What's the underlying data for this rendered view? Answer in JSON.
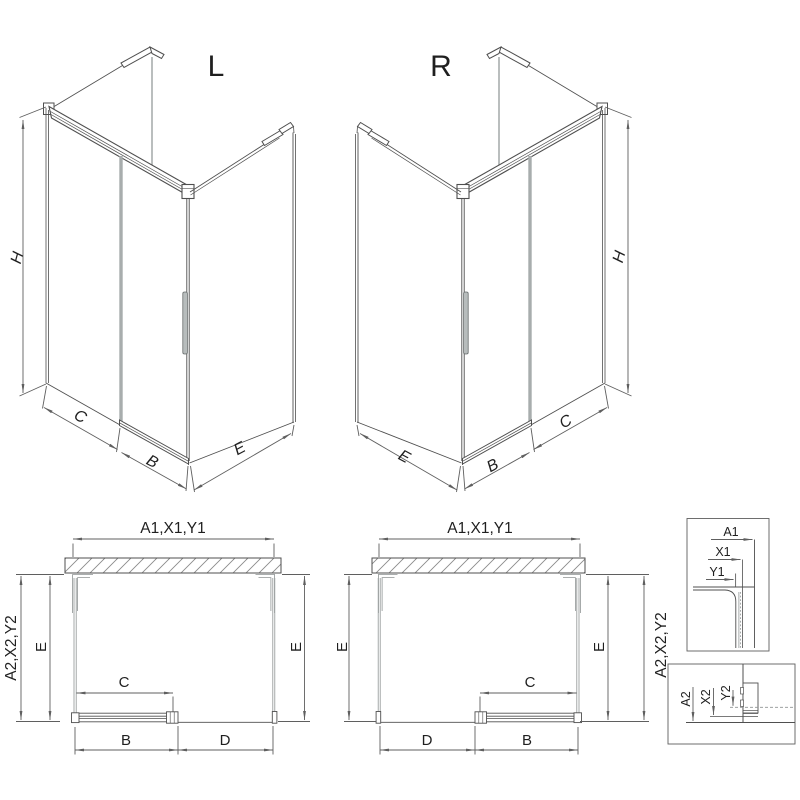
{
  "colors": {
    "line": "#4f4f4f",
    "dim": "#5f5f5f",
    "glass": "#8f9494",
    "light": "#a8adad",
    "text": "#1f1f1f",
    "hatch": "#8a8a8a"
  },
  "iso_left": {
    "title": "L",
    "dim_height": "H",
    "dim_panel": "C",
    "dim_door": "B",
    "dim_side": "E"
  },
  "iso_right": {
    "title": "R",
    "dim_height": "H",
    "dim_panel": "C",
    "dim_door": "B",
    "dim_side": "E"
  },
  "plan_left": {
    "dim_width_wall": "A1,X1,Y1",
    "dim_width_outer": "A2,X2,Y2",
    "dim_depth_left": "E",
    "dim_depth_right": "E",
    "dim_clear": "C",
    "dim_door": "B",
    "dim_fixed": "D"
  },
  "plan_right": {
    "dim_width_wall": "A1,X1,Y1",
    "dim_width_outer": "A2,X2,Y2",
    "dim_depth_left": "E",
    "dim_depth_right": "E",
    "dim_clear": "C",
    "dim_door": "B",
    "dim_fixed": "D"
  },
  "detail_top": {
    "dim_a": "A1",
    "dim_x": "X1",
    "dim_y": "Y1"
  },
  "detail_bottom": {
    "dim_a": "A2",
    "dim_x": "X2",
    "dim_y": "Y2"
  }
}
